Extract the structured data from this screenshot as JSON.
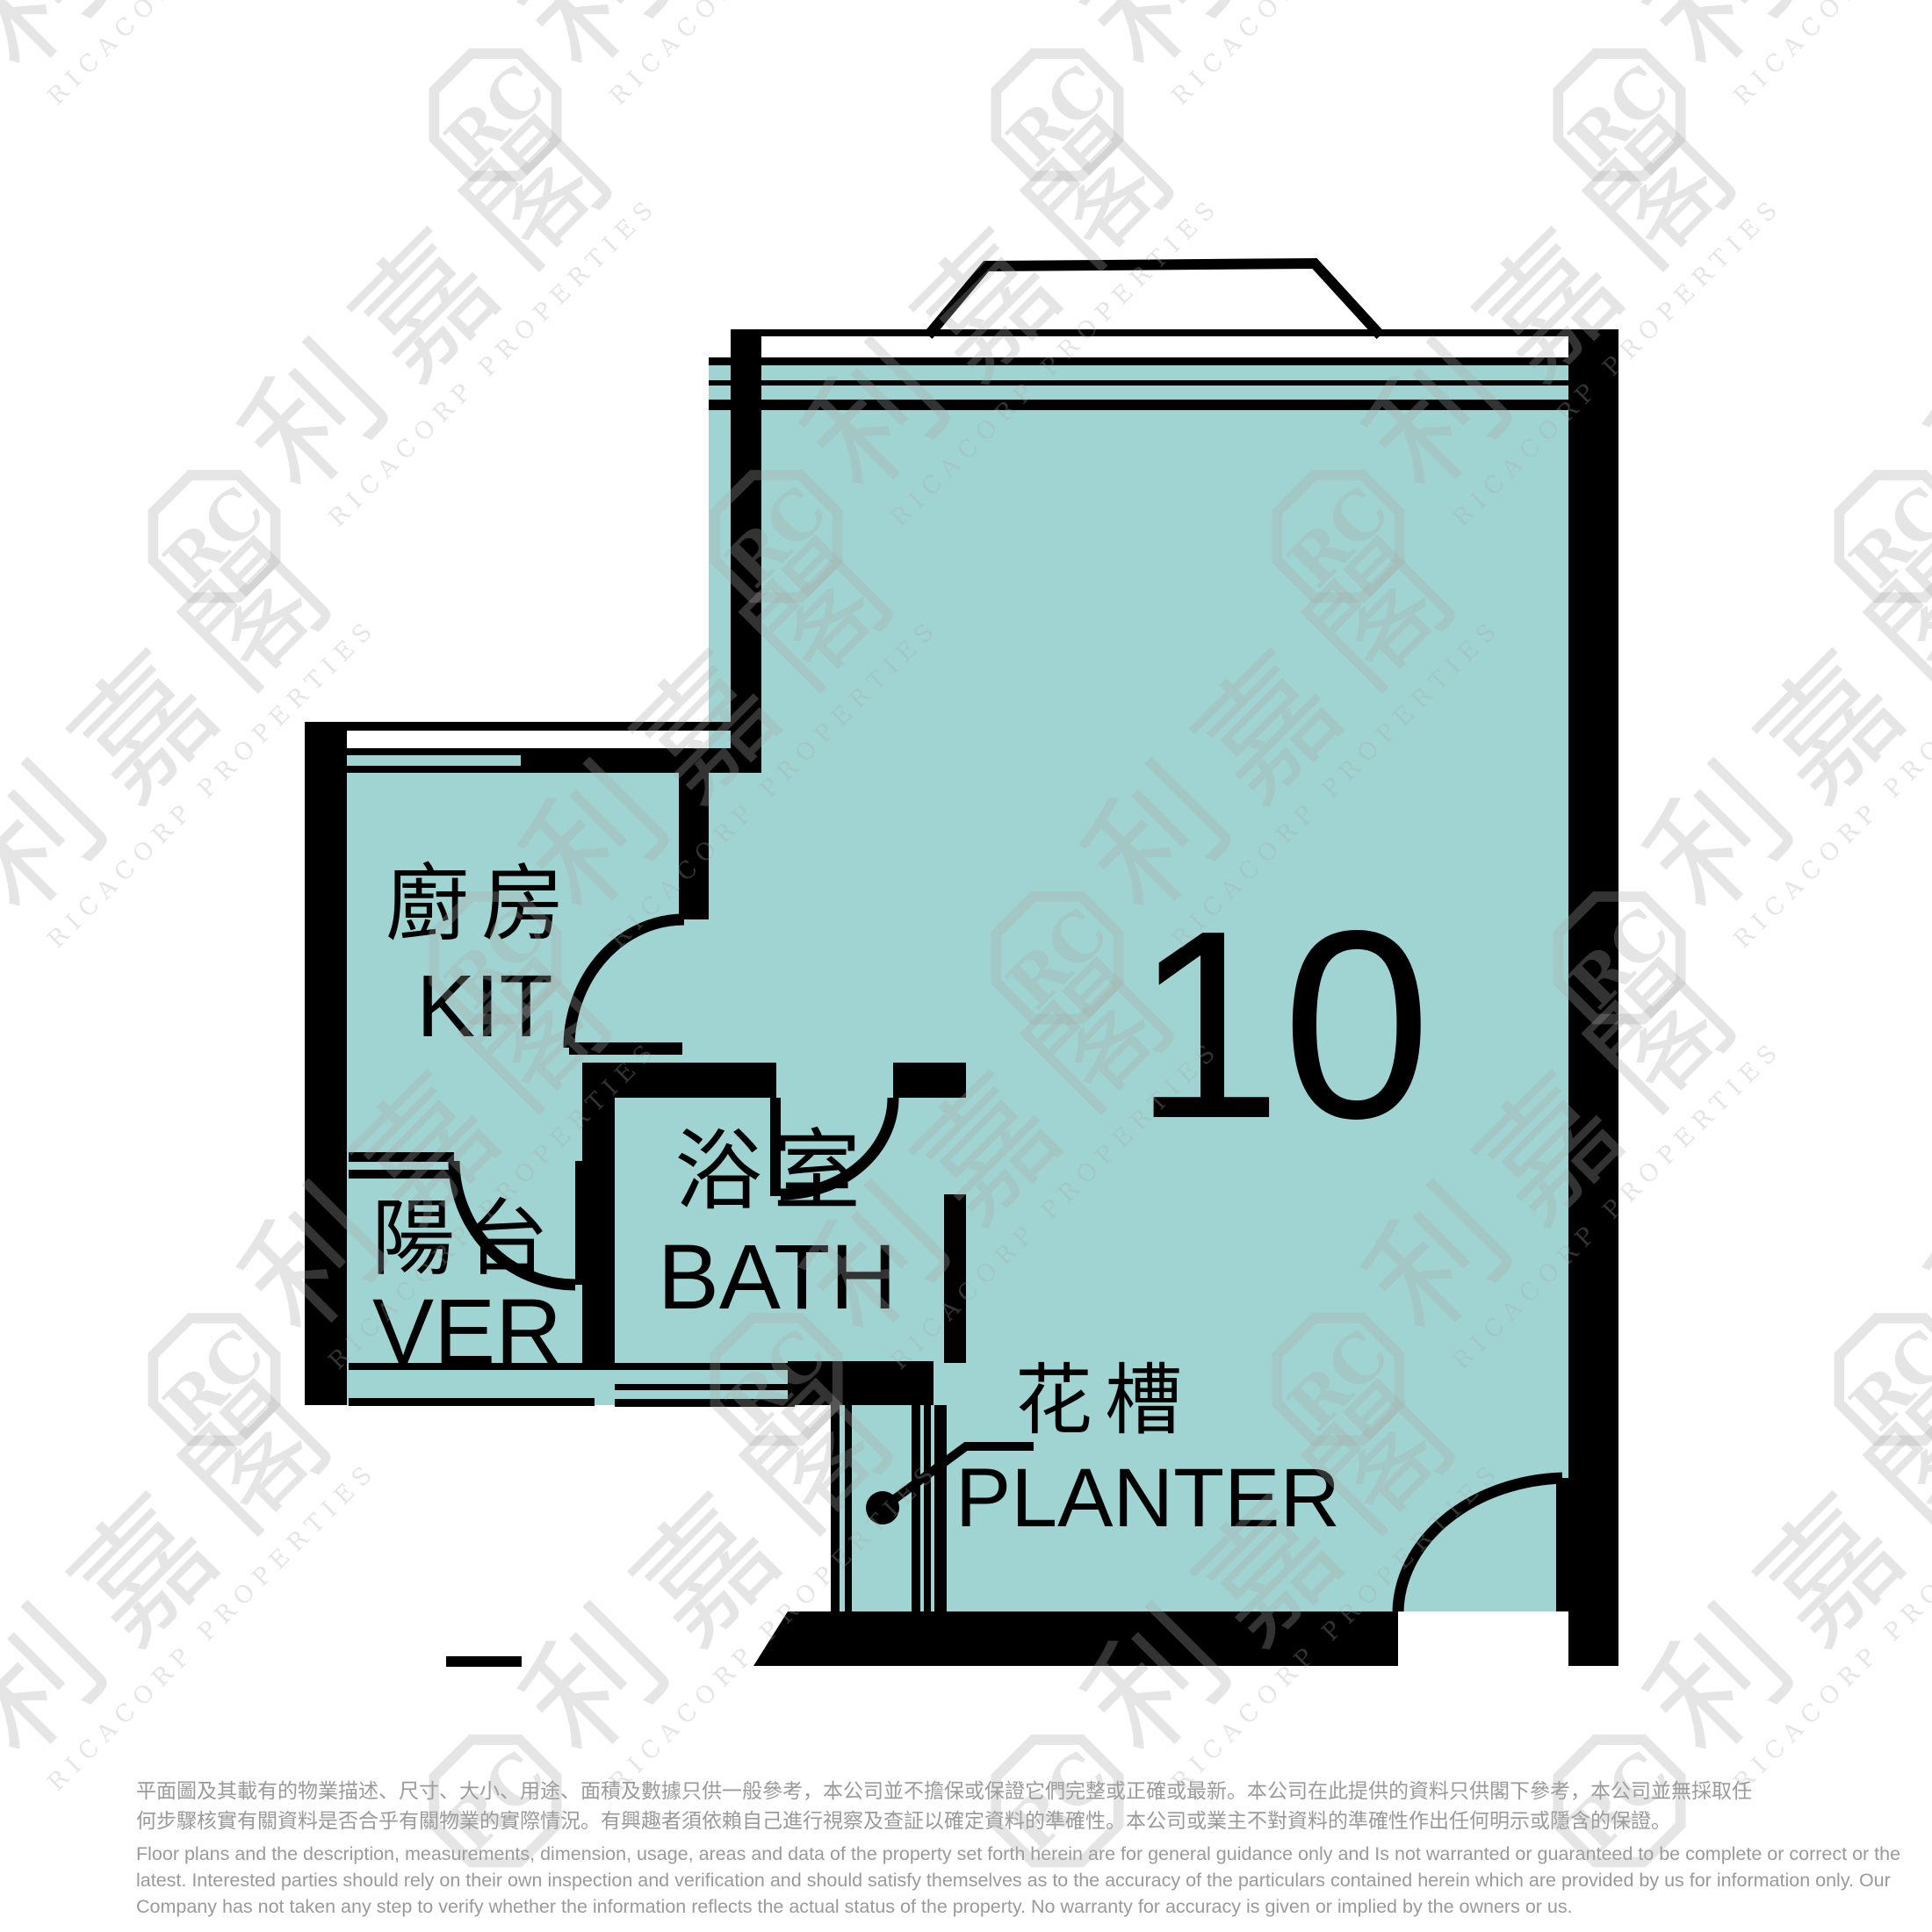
{
  "floor_plan": {
    "unit_number": "10",
    "rooms": [
      {
        "zh": "廚房",
        "en": "KIT"
      },
      {
        "zh": "陽台",
        "en": "VER"
      },
      {
        "zh": "浴室",
        "en": "BATH"
      },
      {
        "zh": "花槽",
        "en": "PLANTER"
      }
    ],
    "colors": {
      "room_fill": "#a0d4d2",
      "wall": "#000000",
      "watermark": "rgba(168,168,168,0.30)",
      "disclaimer_text": "#9a9a9a"
    }
  },
  "watermark": {
    "logo_text": "利嘉閣",
    "company_text": "RICACORP PROPERTIES"
  },
  "disclaimer": {
    "zh_line1": "平面圖及其載有的物業描述、尺寸、大小、用途、面積及數據只供一般參考，本公司並不擔保或保證它們完整或正確或最新。本公司在此提供的資料只供閣下參考，本公司並無採取任",
    "zh_line2": "何步驟核實有關資料是否合乎有關物業的實際情況。有興趣者須依賴自己進行視察及查証以確定資料的準確性。本公司或業主不對資料的準確性作出任何明示或隱含的保證。",
    "en_line1": "Floor plans and the description, measurements, dimension, usage, areas and data of the property set forth herein are for general guidance only and Is not warranted or guaranteed to be complete or correct or the",
    "en_line2": "latest. Interested parties should rely on their own inspection and verification and should satisfy themselves as to the accuracy of the particulars contained herein which are provided by us for information only.  Our",
    "en_line3": "Company has not taken any step to verify whether the information reflects the actual status of the property.  No warranty for accuracy is given or implied by the owners or us."
  }
}
